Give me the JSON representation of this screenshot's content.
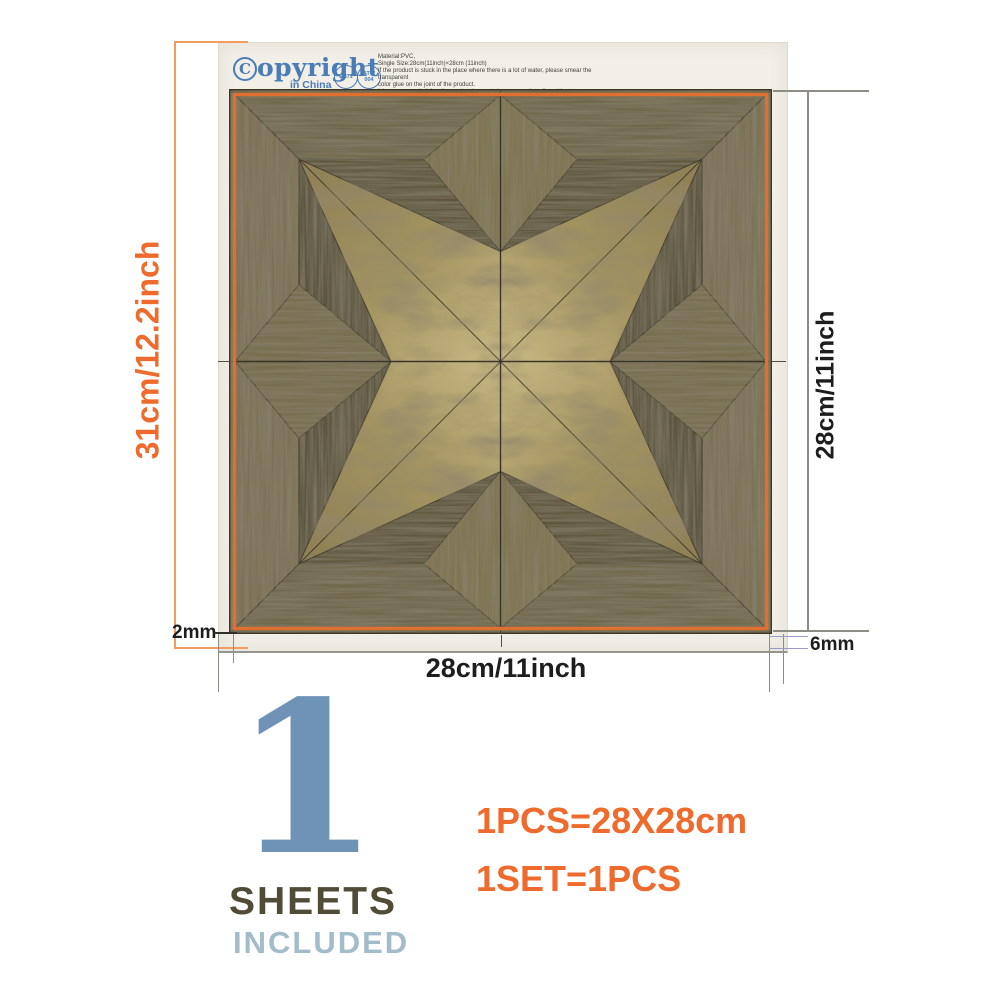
{
  "colors": {
    "accent_orange": "#ef6b2d",
    "dim_orange_line": "#f39c60",
    "logo_blue": "#4a7cb8",
    "count_blue": "#6e93b7",
    "sheets_color": "#514c37",
    "included_color": "#a3bcc9",
    "tile_border_orange": "#e0702f",
    "wood_frame": "#6f674c",
    "wood_gold": "#a9996a",
    "bracket_periwinkle": "#9b9bcb"
  },
  "header": {
    "logo_c": "C",
    "logo_rest": "opyright",
    "logo_sub": "in China",
    "badge1_label": "EN71",
    "badge2_line1": "ATW",
    "badge2_line2": "004",
    "info_lines": [
      "Material:PVC,",
      "Single Size:28cm(11inch)×28cm  (11inch)",
      "If the product is stuck in the place where there is a lot of water, please smear the transparent",
      "color glue on the joint of the product.",
      "It is recommended that the product be pasted on a smooth wall or object."
    ]
  },
  "dims": {
    "paper_height_label": "31cm/12.2inch",
    "tile_height_label": "28cm/11inch",
    "tile_width_label": "28cm/11inch",
    "left_margin_label": "2mm",
    "right_margin_label": "6mm"
  },
  "footer": {
    "count": "1",
    "sheets_label": "SHEETS",
    "included_label": "INCLUDED",
    "spec_line1": "1PCS=28X28cm",
    "spec_line2": "1SET=1PCS"
  }
}
